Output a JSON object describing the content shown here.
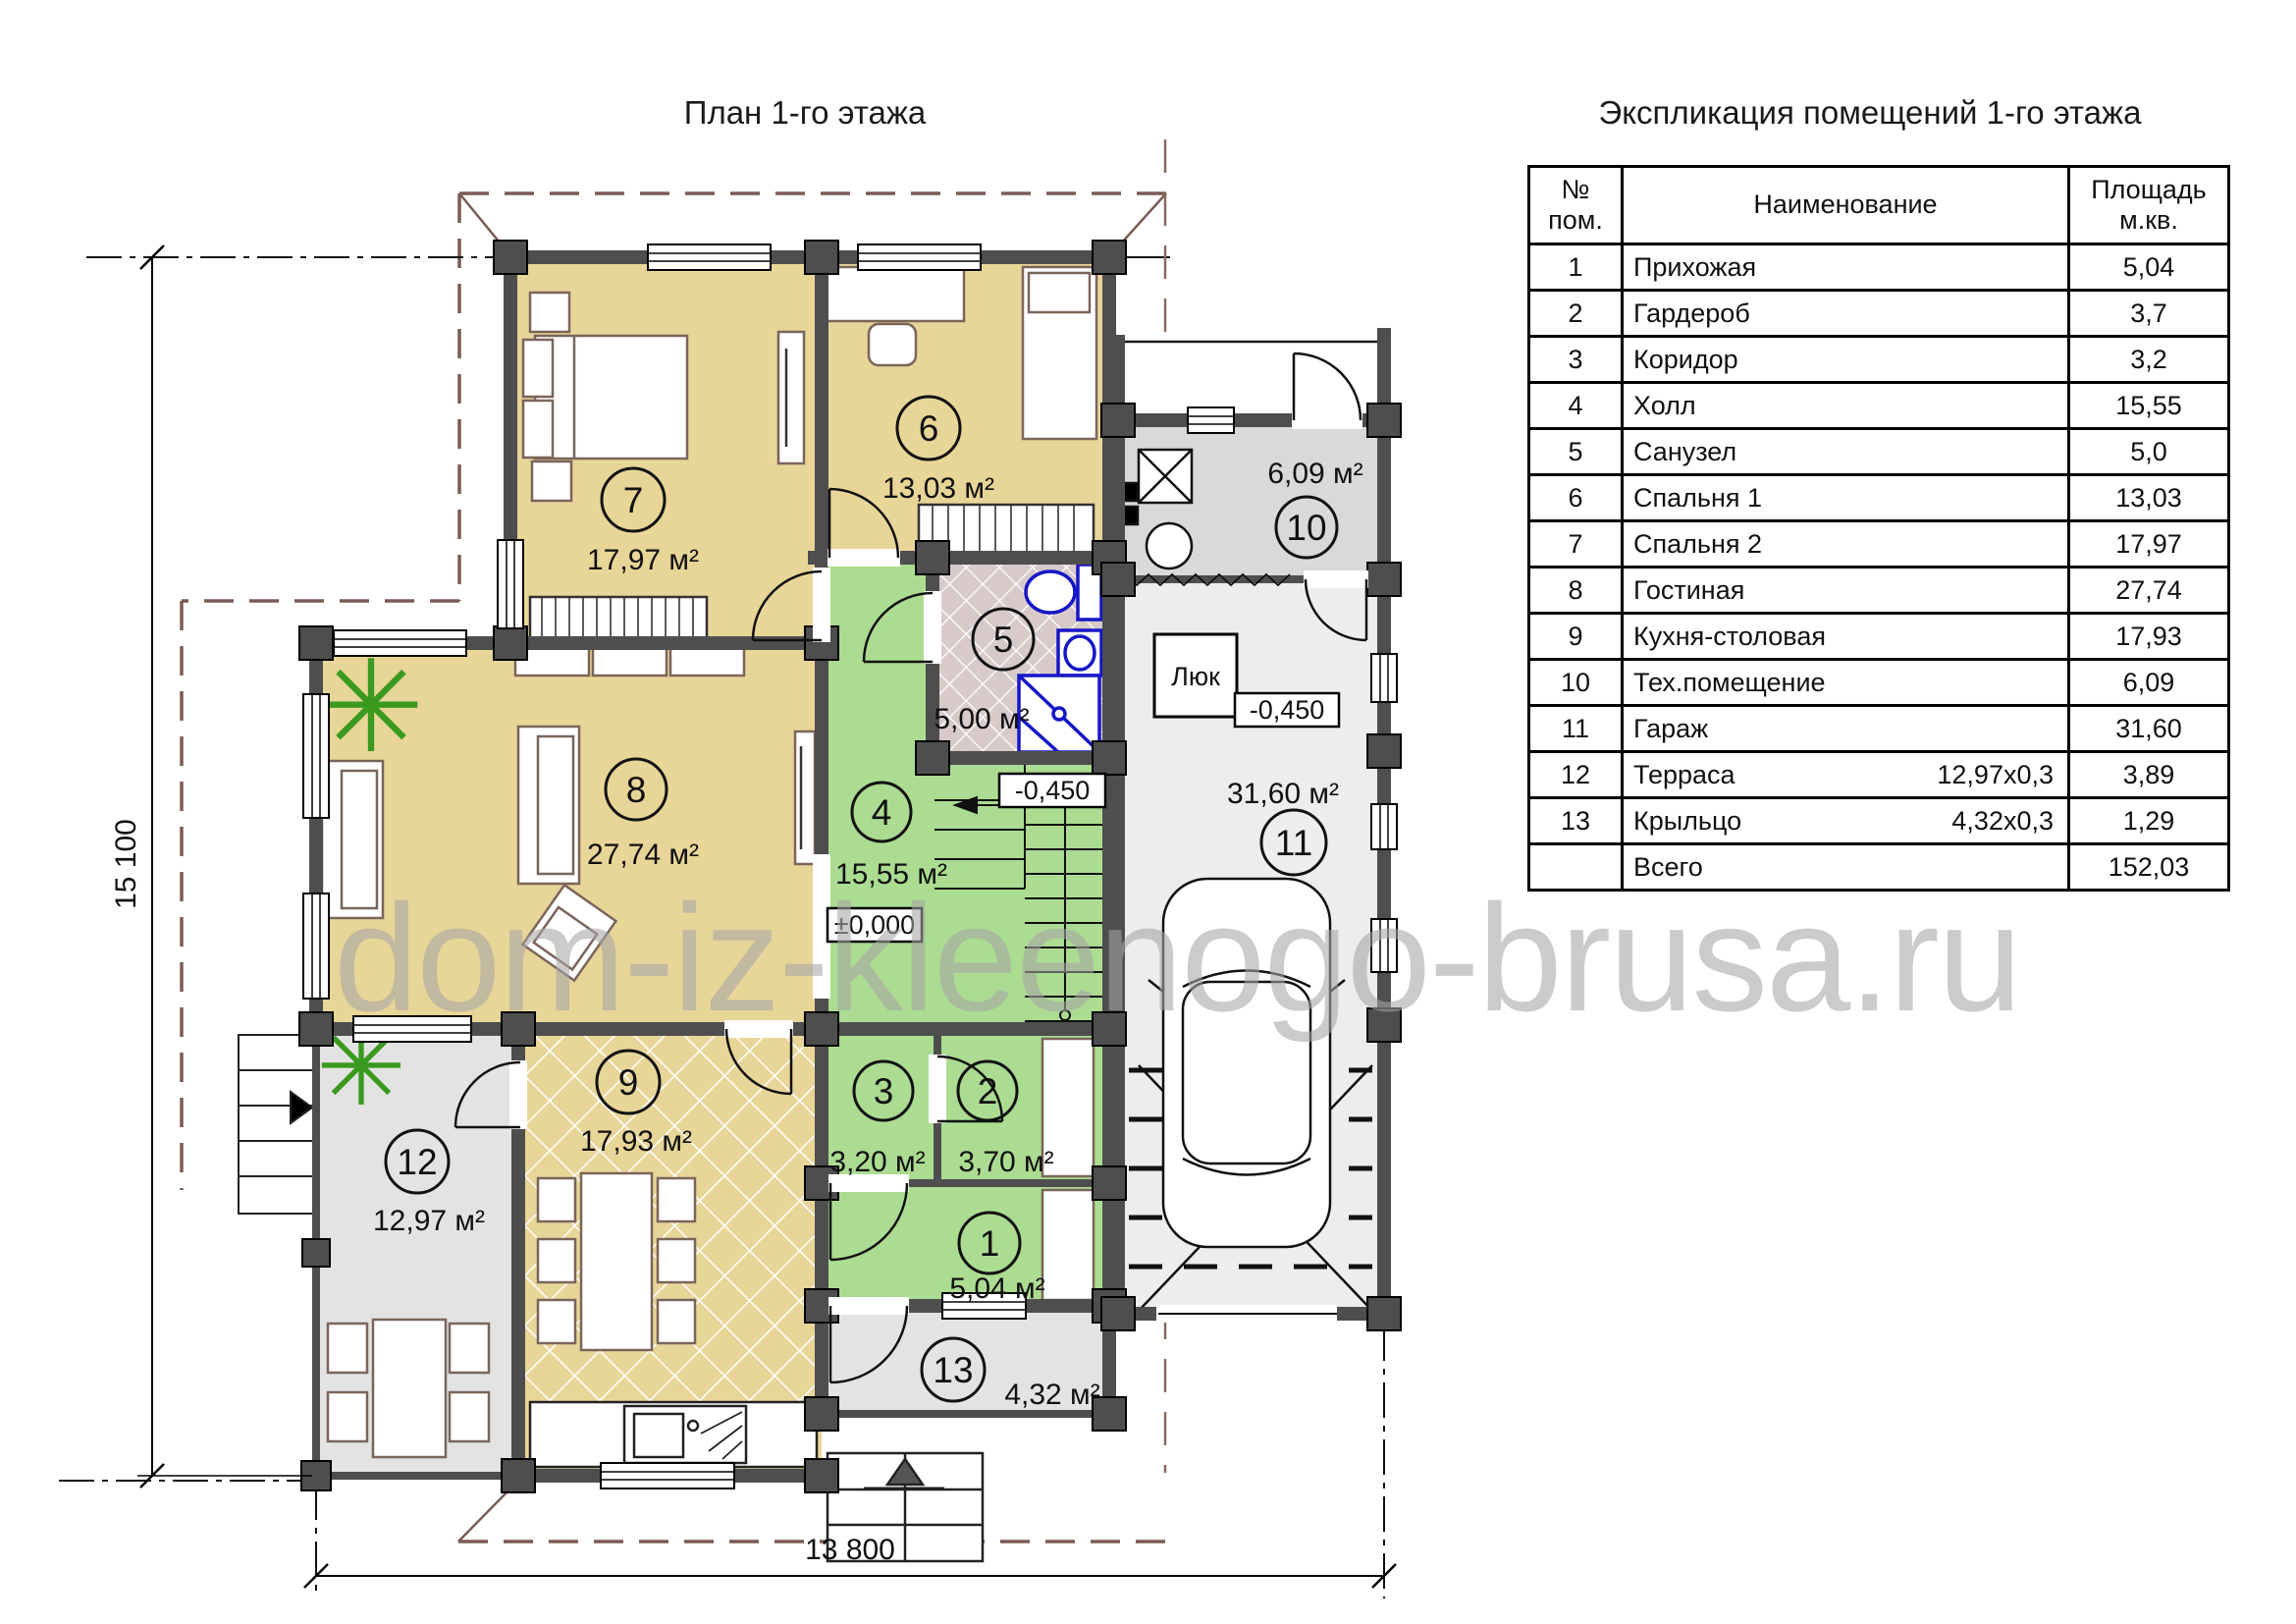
{
  "page": {
    "plan_title": "План 1-го этажа",
    "watermark": "dom-iz-kleenogo-brusa.ru"
  },
  "dimensions": {
    "width_label": "13 800",
    "height_label": "15 100"
  },
  "plan_labels": {
    "hatch_label": "Люк",
    "level_main": "±0,000",
    "level_stairs": "-0,450",
    "level_garage": "-0,450"
  },
  "rooms": [
    {
      "number": "1",
      "area": "5,04 м²"
    },
    {
      "number": "2",
      "area": "3,70 м²"
    },
    {
      "number": "3",
      "area": "3,20 м²"
    },
    {
      "number": "4",
      "area": "15,55 м²"
    },
    {
      "number": "5",
      "area": "5,00 м²"
    },
    {
      "number": "6",
      "area": "13,03 м²"
    },
    {
      "number": "7",
      "area": "17,97 м²"
    },
    {
      "number": "8",
      "area": "27,74 м²"
    },
    {
      "number": "9",
      "area": "17,93 м²"
    },
    {
      "number": "10",
      "area": "6,09 м²"
    },
    {
      "number": "11",
      "area": "31,60 м²"
    },
    {
      "number": "12",
      "area": "12,97 м²"
    },
    {
      "number": "13",
      "area": "4,32 м²"
    }
  ],
  "table": {
    "title": "Экспликация помещений 1-го этажа",
    "header": {
      "num_line1": "№",
      "num_line2": "пом.",
      "name": "Наименование",
      "area_line1": "Площадь",
      "area_line2": "м.кв."
    },
    "rows": [
      {
        "num": "1",
        "name": "Прихожая",
        "dims": "",
        "area": "5,04"
      },
      {
        "num": "2",
        "name": "Гардероб",
        "dims": "",
        "area": "3,7"
      },
      {
        "num": "3",
        "name": "Коридор",
        "dims": "",
        "area": "3,2"
      },
      {
        "num": "4",
        "name": "Холл",
        "dims": "",
        "area": "15,55"
      },
      {
        "num": "5",
        "name": "Санузел",
        "dims": "",
        "area": "5,0"
      },
      {
        "num": "6",
        "name": "Спальня 1",
        "dims": "",
        "area": "13,03"
      },
      {
        "num": "7",
        "name": "Спальня 2",
        "dims": "",
        "area": "17,97"
      },
      {
        "num": "8",
        "name": "Гостиная",
        "dims": "",
        "area": "27,74"
      },
      {
        "num": "9",
        "name": "Кухня-столовая",
        "dims": "",
        "area": "17,93"
      },
      {
        "num": "10",
        "name": "Тех.помещение",
        "dims": "",
        "area": "6,09"
      },
      {
        "num": "11",
        "name": "Гараж",
        "dims": "",
        "area": "31,60"
      },
      {
        "num": "12",
        "name": "Терраса",
        "dims": "12,97х0,3",
        "area": "3,89"
      },
      {
        "num": "13",
        "name": "Крыльцо",
        "dims": "4,32х0,3",
        "area": "1,29"
      },
      {
        "num": "",
        "name": "Всего",
        "dims": "",
        "area": "152,03"
      }
    ]
  }
}
